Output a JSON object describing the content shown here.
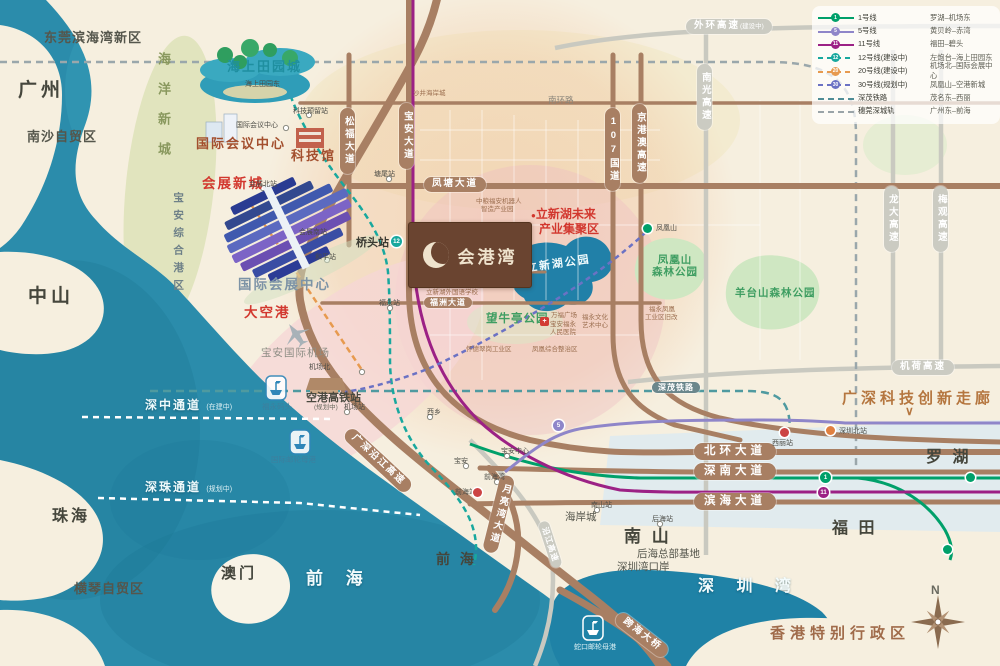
{
  "colors": {
    "sea": "#2b8cab",
    "land": "#f6efdf",
    "road_brown": "#a87f63",
    "line1": "#00a06a",
    "line5": "#8f86c9",
    "line11": "#9c2185",
    "line12": "#18a89e",
    "line20": "#e79a4f",
    "line30": "#6b72c4",
    "shenmao_rail": "#4f9aa0",
    "intercity_rail": "#9aa7ab",
    "accent_red": "#d2372e",
    "park_green": "#3f9e62",
    "logo_brown": "#6a4430"
  },
  "legend": {
    "rows": [
      {
        "badge": "1",
        "name": "1号线",
        "route": "罗湖–机场东"
      },
      {
        "badge": "5",
        "name": "5号线",
        "route": "黄贝岭–赤湾"
      },
      {
        "badge": "11",
        "name": "11号线",
        "route": "福田–碧头"
      },
      {
        "badge": "12",
        "name": "12号线(建设中)",
        "route": "左炮台–海上田园东"
      },
      {
        "badge": "20",
        "name": "20号线(建设中)",
        "route": "机场北–国际会展中心"
      },
      {
        "badge": "30",
        "name": "30号线(规划中)",
        "route": "凤凰山–空港新城"
      },
      {
        "badge": "",
        "name": "深茂铁路",
        "route": "茂名东–西丽"
      },
      {
        "badge": "",
        "name": "穗莞深城轨",
        "route": "广州东–前海"
      }
    ]
  },
  "project": {
    "name": "会港湾"
  },
  "regions": {
    "dongguan": "东莞滨海湾新区",
    "guangzhou": "广州",
    "nansha": "南沙自贸区",
    "zhongshan": "中山",
    "zhuhai": "珠海",
    "macau": "澳门",
    "hengqin": "横琴自贸区",
    "qianhai_sea": "前 海",
    "qianhai": "前 海",
    "nanshan": "南 山",
    "futian": "福 田",
    "luohu": "罗 湖",
    "hongkong": "香港特别行政区",
    "shenzhen_bay": "深 圳 湾",
    "haiyang": "海洋新城",
    "baoan_port": "宝安综合港区"
  },
  "landmarks": {
    "sea_pastoral": "海上田园城",
    "convention_center": "国际会议中心",
    "science_museum": "科技馆",
    "exhibition_city": "会展新城",
    "exhibition_center": "国际会展中心",
    "big_airport": "大空港",
    "airport": "宝安国际机场",
    "airport_hsr": "空港高铁站",
    "airport_hsr_note": "(规划中)",
    "fuyong_pier": "福永码头",
    "cruise_port": "国际邮轮母港",
    "shekou_port": "蛇口邮轮母港",
    "corridor": "广深科技创新走廊",
    "corridor_chevron": "∨",
    "szt": "深中通道",
    "szt_note": "(在建中)",
    "shenzhu": "深珠通道",
    "shenzhu_note": "(规划中)",
    "lixin_bullet": "●",
    "lixin_badge1": "立新湖未来",
    "lixin_badge2": "产业集聚区",
    "lixin_park": "立新湖公园",
    "fenghuang_park1": "凤凰山",
    "fenghuang_park2": "森林公园",
    "yangtai_park": "羊台山森林公园",
    "wangniuting": "望牛亭公园",
    "houhai_base": "后海总部基地",
    "bay_port": "深圳湾口岸",
    "coastal_city_mall": "海岸城",
    "qiaotou": "桥头站"
  },
  "roads": {
    "songfu": "松福大道",
    "baoan_ave": "宝安大道",
    "fengtang": "凤塘大道",
    "fuzhou": "福洲大道",
    "qiaohe": "桥和路",
    "nanhuan": "南环路",
    "g107": "107国道",
    "jinggangao": "京港澳高速",
    "nanguang": "南光高速",
    "waihuan": "外环高速",
    "waihuan_note": "(建设中)",
    "longda": "龙大高速",
    "meiguan": "梅观高速",
    "jihe": "机荷高速",
    "beihuan": "北环大道",
    "shennan": "深南大道",
    "binhai": "滨海大道",
    "moonbay": "月亮湾大道",
    "yanjiang_gs": "广深沿江高速",
    "yanjiang": "沿江高速",
    "bridge": "跨海大桥",
    "shenmao": "深茂铁路"
  },
  "stations": [
    "海上田园东",
    "国际会议中心",
    "科技预留站",
    "会展北站",
    "会展南站",
    "和平站",
    "塘尾站",
    "福永站",
    "机场北",
    "机场站",
    "西乡",
    "宝安",
    "宝安中心",
    "前海湾",
    "前海站",
    "南山站",
    "后海站",
    "西丽站",
    "深圳北站",
    "凤凰山"
  ],
  "pois": [
    "沙井海岸城",
    "中粮福安机器人",
    "智造产业园",
    "天安数码城新兴产业园区",
    "立新湖外国语学校",
    "福永凤凰",
    "工业区旧改",
    "宝安福永",
    "人民医院",
    "万福广场",
    "福永文化",
    "艺术中心",
    "怀德翠岗工业区",
    "凤凰综合整治区"
  ],
  "badges": {
    "b1": "1",
    "b11": "11",
    "b5": "5",
    "b12": "12",
    "cross": "+"
  },
  "compass": {
    "n": "N"
  }
}
